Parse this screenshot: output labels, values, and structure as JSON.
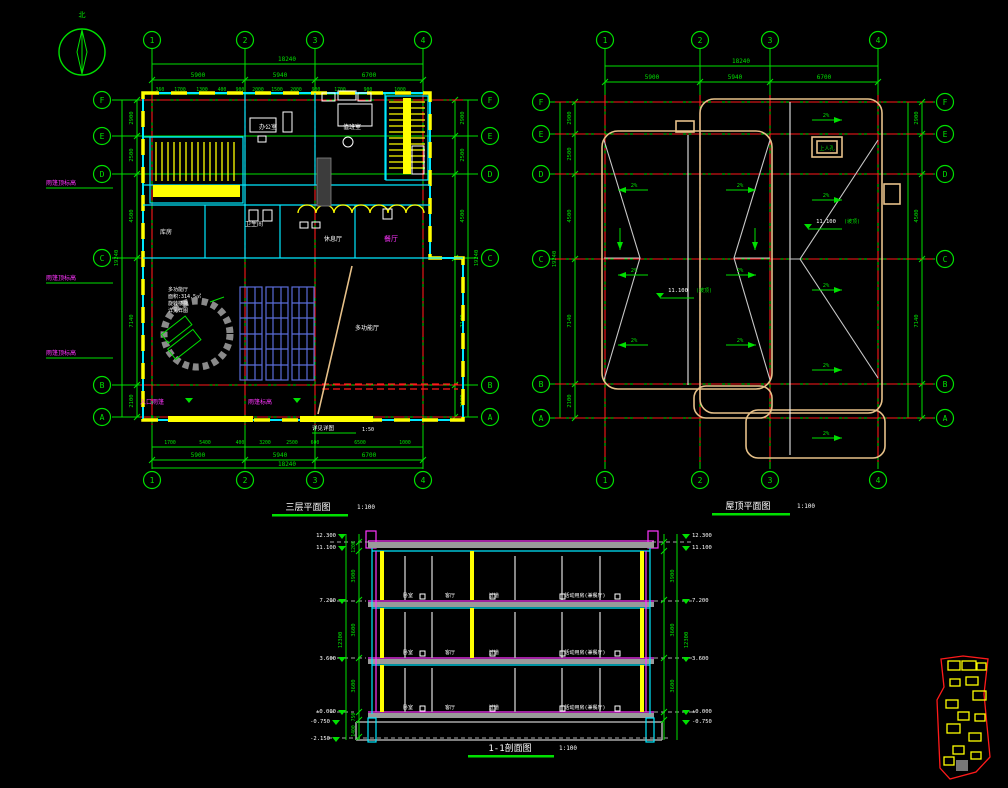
{
  "palette": {
    "background": "#000000",
    "grid_green": "#00e000",
    "red": "#ff1a1a",
    "cyan": "#00e8ff",
    "yellow": "#ffff00",
    "magenta": "#ff35ff",
    "tan": "#e7c189",
    "hip_gray": "#c8c8c8",
    "slab_gray": "#a8a8a8",
    "panel_navy": "#5a6cd8"
  },
  "north": {
    "label": "北"
  },
  "floor_plan": {
    "title": "三层平面图",
    "scale": "1:100",
    "axes_cols": [
      "1",
      "2",
      "3",
      "4"
    ],
    "axes_rows": [
      "F",
      "E",
      "D",
      "C",
      "B",
      "A"
    ],
    "top_total": "18240",
    "top_segs": [
      "5900",
      "5940",
      "6700"
    ],
    "top_detail": [
      "360",
      "1700",
      "1300",
      "400",
      "900",
      "2000",
      "1500",
      "2000",
      "900",
      "1700",
      "900",
      "1000"
    ],
    "bottom_detail": [
      "1700",
      "5400",
      "400",
      "3200",
      "2500",
      "600",
      "6500",
      "1000"
    ],
    "bottom_segs": [
      "5900",
      "5940",
      "6700"
    ],
    "bottom_total": "18240",
    "left_dims": [
      "2900",
      "2500",
      "4500",
      "7140",
      "2100"
    ],
    "left_total": "19240",
    "right_dims": [
      "2900",
      "2500",
      "4500",
      "7140",
      "2100"
    ],
    "right_total": "19240",
    "rooms": {
      "office": "办公室",
      "duty": "值班室",
      "store": "库房",
      "wc": "卫生间",
      "lounge": "休息厅",
      "dining": "餐厅",
      "hall": "多功能厅"
    },
    "note_lines": [
      "多功能厅",
      "面积:314.5㎡",
      "旋转楼梯",
      "详见详图"
    ],
    "canopy_label": "雨篷顶标高",
    "entry_canopy_label": "入口雨篷",
    "canopy2_label": "雨篷标高",
    "ref_label": "详见详图",
    "ref_scale": "1:50"
  },
  "roof_plan": {
    "title": "屋顶平面图",
    "scale": "1:100",
    "axes_cols": [
      "1",
      "2",
      "3",
      "4"
    ],
    "axes_rows": [
      "F",
      "E",
      "D",
      "C",
      "B",
      "A"
    ],
    "top_total": "18240",
    "top_segs": [
      "5900",
      "5940",
      "6700"
    ],
    "left_dims": [
      "2900",
      "2500",
      "4500",
      "7140",
      "2100"
    ],
    "left_total": "19240",
    "right_dims": [
      "2900",
      "4500",
      "7140"
    ],
    "slope": "2%",
    "elev_left": "11.100",
    "elev_right": "11.100",
    "elev_note": "(坡顶)",
    "hatch_label": "上人孔"
  },
  "section": {
    "title": "1-1剖面图",
    "scale": "1:100",
    "elev_left": [
      "12.300",
      "11.100",
      "7.200",
      "3.600",
      "±0.000",
      "-0.750",
      "-2.150"
    ],
    "elev_right": [
      "12.300",
      "11.100",
      "7.200",
      "3.600",
      "±0.000",
      "-0.750"
    ],
    "dims": [
      "3900",
      "3600",
      "3600"
    ],
    "dim_parapet": "1200",
    "dim_total": "12300",
    "dims_found": [
      "750",
      "1400"
    ],
    "rooms": [
      "卧室",
      "客厅",
      "过道"
    ],
    "room_big": "活动用房(兼餐厅)"
  }
}
